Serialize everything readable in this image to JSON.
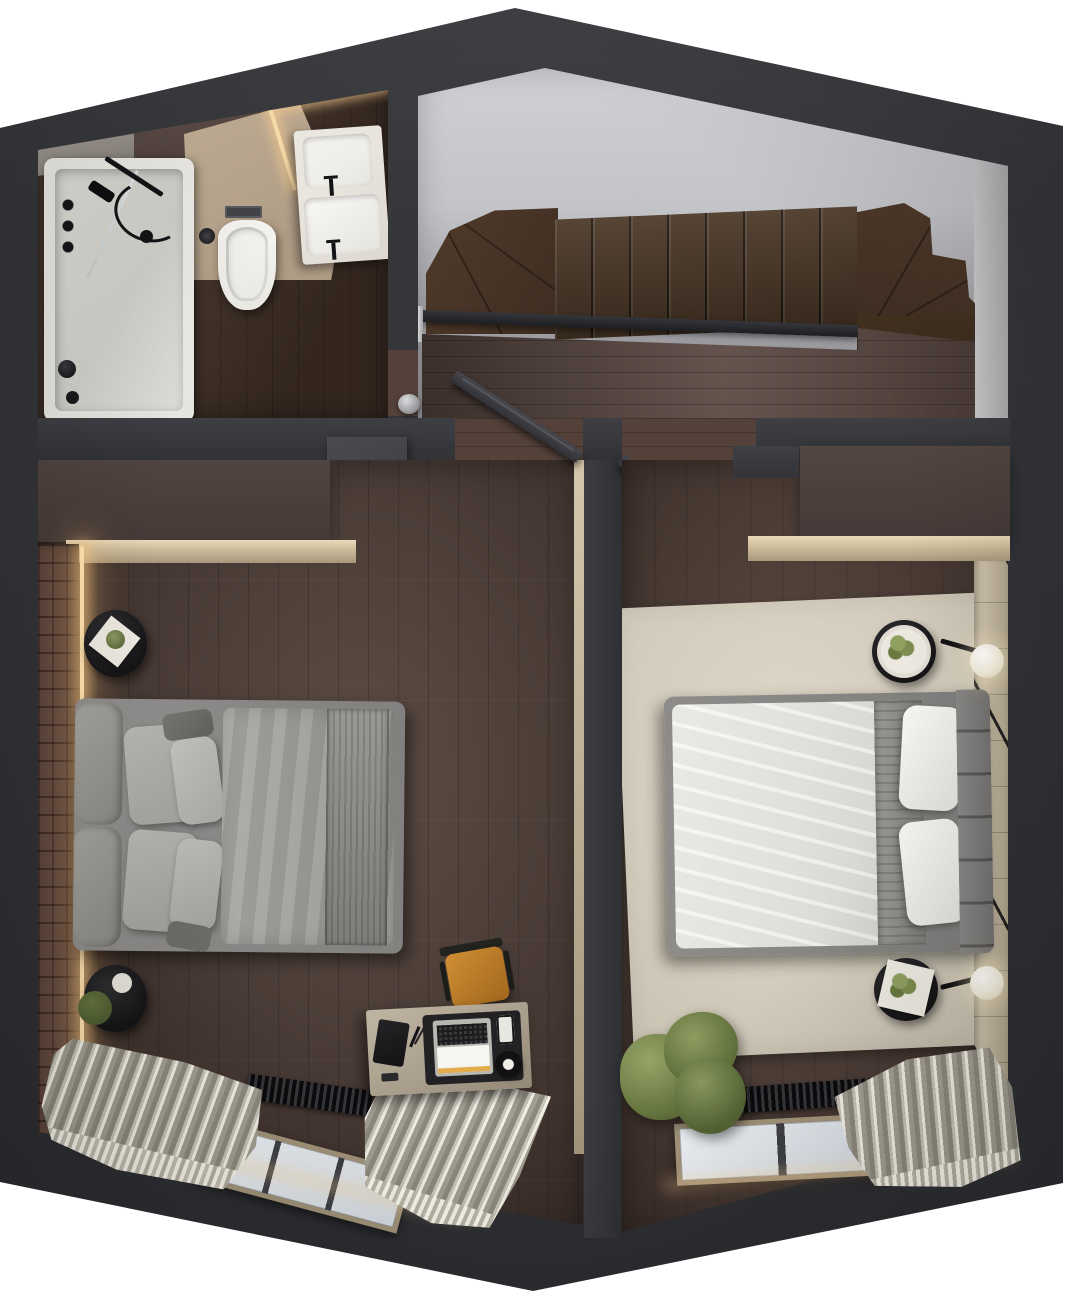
{
  "scene": {
    "title": "Top-down 3D floor plan render — attic level",
    "type": "photorealistic plan-view render",
    "description": "Top-down render of an attic floor: bathroom (top left), winder staircase hall (top right), two bedrooms (bottom), white background around dark charcoal walls",
    "background": "#ffffff"
  },
  "palette": {
    "bg": "#ffffff",
    "wall": "#36373b",
    "wall_light": "#404145",
    "bath_wood": "#4a372c",
    "tile_beige": "#cdb89e",
    "tub_white": "#f5f3ee",
    "fixture_black": "#141416",
    "led": "#ffe2ae",
    "void_gray": "#d0d1d5",
    "stair_wood": "#503b2b",
    "landing_wood": "#584640",
    "railing": "#1d1e21",
    "floor_left": "#53413a",
    "floor_right": "#57443c",
    "brick": "#5e463d",
    "wardrobe": "#514440",
    "bench": "#ead9ba",
    "bed_gray": "#8f8e8c",
    "duvet_gray": "#a9a8a2",
    "duvet_white": "#f4f2ef",
    "headboard": "#8a8886",
    "nightstand": "#151517",
    "tray": "#ece8df",
    "plant": "#67773f",
    "rug": "#e0d9ca",
    "panel": "#d6cab3",
    "globe": "#f2ecd9",
    "door": "#47484e",
    "divider_face": "#d3c6ac",
    "desk_top": "#c0b4a2",
    "mat_black": "#222224",
    "chair_orange": "#d08e34",
    "radiator": "#0b0b0d",
    "window_frame": "#a3947a",
    "glass": "#eff3f7",
    "curtain_dark": "#8e8a7f",
    "curtain_light": "#f3f0e6"
  },
  "rooms": {
    "bathroom": {
      "label": "Bathroom",
      "fixtures": [
        "bathtub with black shower set",
        "glass shower screen",
        "wall-hung toilet with flush plate",
        "toilet brush",
        "double-basin vanity with black faucets",
        "warm LED cove light",
        "dark wood floor",
        "beige and gray wall tile"
      ]
    },
    "stair_hall": {
      "label": "Stair hall",
      "fixtures": [
        "winder staircase (approx. 15 dark wood treads)",
        "black railing with light post",
        "dark wood landing floor",
        "light gray stair void"
      ]
    },
    "bedroom_left": {
      "label": "Bedroom — left",
      "fixtures": [
        "brick accent wall with LED strip",
        "wardrobe with beige bench",
        "open door",
        "2 round black nightstands with plants",
        "double bed with gray bedding and cushion headboard",
        "orange desk chair",
        "desk with laptop, phone, headphones and speaker",
        "black radiator",
        "3-pane window",
        "gray-white curtains"
      ]
    },
    "bedroom_right": {
      "label": "Bedroom — right",
      "fixtures": [
        "wardrobe with beige bench",
        "open door",
        "large beige area rug",
        "double bed with white duvet, gray runner and tufted headboard",
        "2 round black side tables with plants",
        "2 black wall lamps with glowing globes",
        "light wood panel accent wall",
        "large green plant",
        "black radiator",
        "2-pane window",
        "gray curtains"
      ]
    }
  }
}
